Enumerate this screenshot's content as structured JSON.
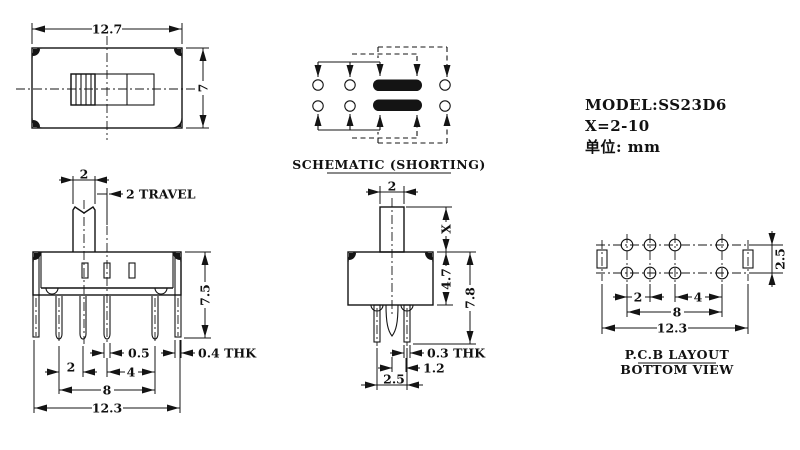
{
  "info": {
    "model": "MODEL:SS23D6",
    "x_range": "X=2-10",
    "unit": "单位: mm"
  },
  "views": {
    "top": {
      "dim_width": "12.7",
      "dim_height": "7"
    },
    "schematic": {
      "caption": "SCHEMATIC (SHORTING)"
    },
    "front": {
      "dim_knob_width": "2",
      "dim_travel": "2 TRAVEL",
      "dim_height": "7.5",
      "dim_pin_width": "0.5",
      "dim_bracket_thk": "0.4 THK",
      "dim_pitch_a": "2",
      "dim_pitch_b": "4",
      "dim_span": "8",
      "dim_overall": "12.3"
    },
    "side": {
      "dim_knob_width": "2",
      "dim_knob_height": "X",
      "dim_body_height": "4.7",
      "dim_total_height": "7.8",
      "dim_pin_thk": "0.3 THK",
      "dim_pin_gap": "1.2",
      "dim_row_pitch": "2.5"
    },
    "pcb": {
      "dim_row_pitch": "2.5",
      "dim_pitch_a": "2",
      "dim_pitch_b": "4",
      "dim_span": "8",
      "dim_overall": "12.3",
      "caption_line1": "P.C.B LAYOUT",
      "caption_line2": "BOTTOM VIEW"
    }
  }
}
